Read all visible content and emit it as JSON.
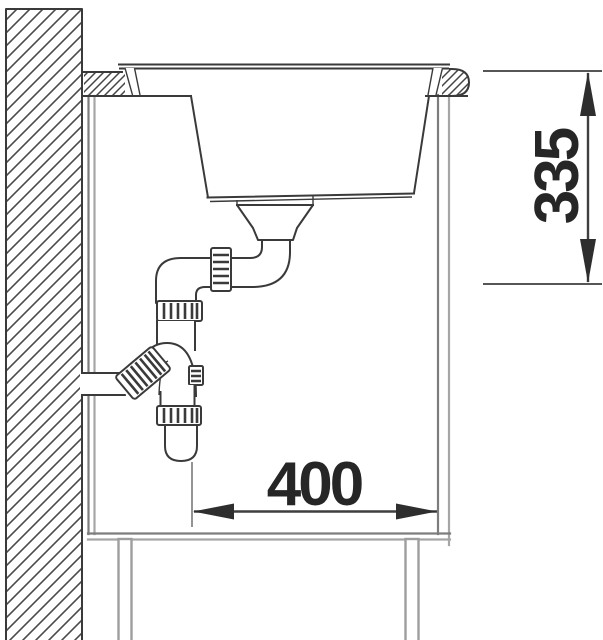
{
  "diagram": {
    "kind": "sink-installation-cross-section",
    "dimensions": {
      "height_mm": {
        "value": "335"
      },
      "width_mm": {
        "value": "400"
      }
    },
    "colors": {
      "line": "#3a3a3a",
      "cabinet": "#7d7d7d",
      "cabinet_shadow": "#a6a6a6",
      "dimension_text": "#262626",
      "background": "#ffffff"
    }
  }
}
